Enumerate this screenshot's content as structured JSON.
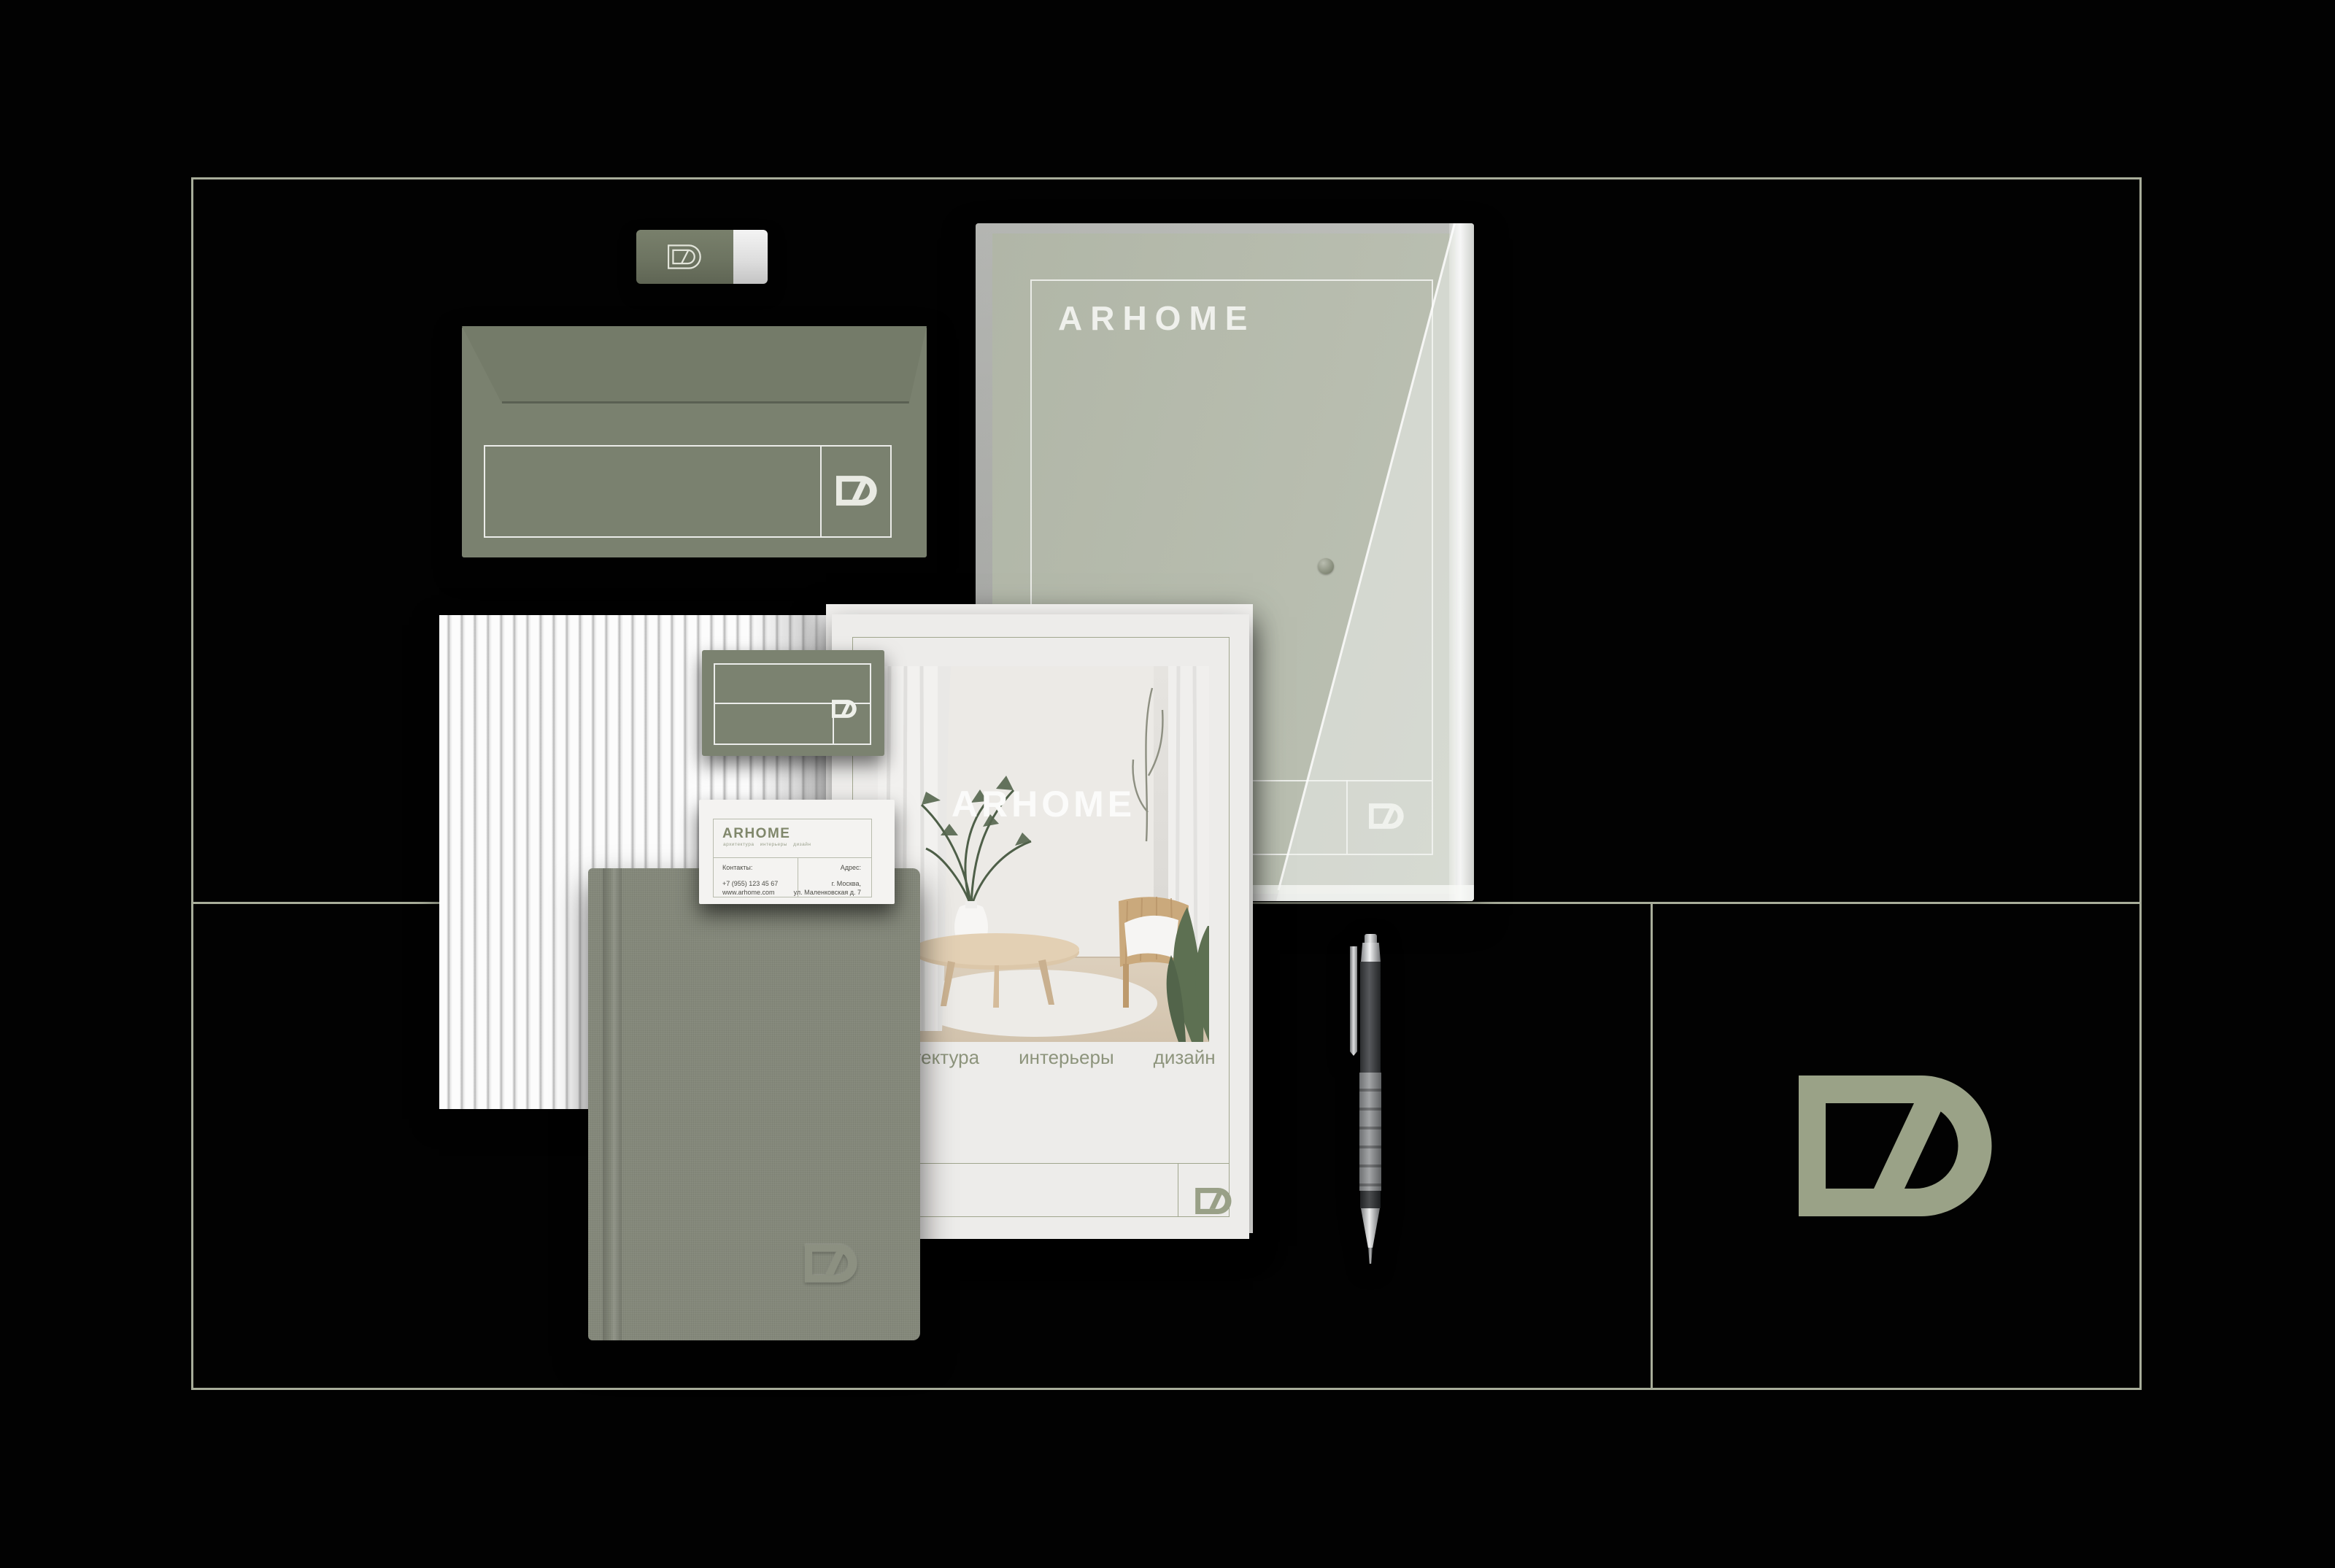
{
  "brand": {
    "name": "ARHOME",
    "monogram": "DZ",
    "tagline_words": [
      "архитектура",
      "интерьеры",
      "дизайн"
    ]
  },
  "folder_document": {
    "title": "ARHOME"
  },
  "magazine": {
    "title": "ARHOME",
    "tagline_words": [
      "архитектура",
      "интерьеры",
      "дизайн"
    ]
  },
  "business_card": {
    "brand": "ARHOME",
    "tagline": "архитектура интерьеры дизайн",
    "contacts_label": "Контакты:",
    "phone": "+7 (955) 123 45 67",
    "website": "www.arhome.com",
    "address_label": "Адрес:",
    "address_line1": "г. Москва,",
    "address_line2": "ул. Маленковская д. 7"
  },
  "colors": {
    "background": "#020202",
    "frame_line": "#a8ad9a",
    "envelope_olive": "#7a816f",
    "document_olive": "#99a08c",
    "logo_sage": "#9aa287",
    "paper_white": "#f1f0ee"
  }
}
